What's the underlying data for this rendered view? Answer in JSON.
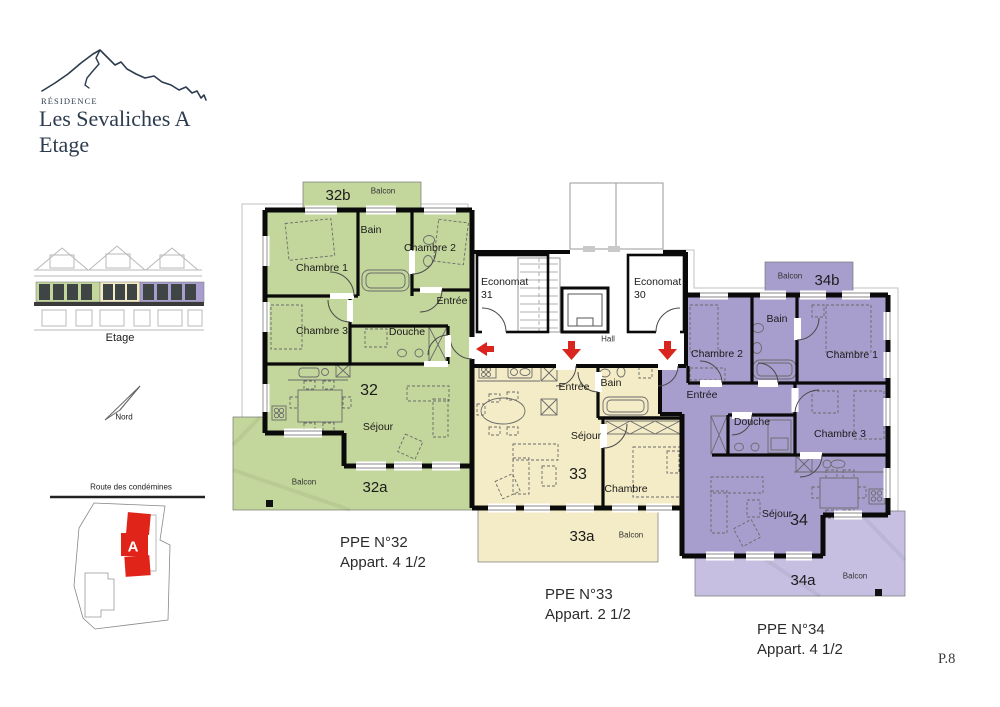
{
  "page": {
    "number": "P.8"
  },
  "logo": {
    "residence": "RÉSIDENCE",
    "name": "Les Sevaliches A",
    "floor": "Etage"
  },
  "elevation": {
    "caption": "Etage"
  },
  "north_arrow": {
    "label": "Nord"
  },
  "site_plan": {
    "road": "Route des condémines",
    "building_letter": "A"
  },
  "colors": {
    "apt32_green": "#c3d69b",
    "apt33_yellow": "#f4ecc6",
    "apt34_purple": "#a89ecd",
    "balcony34_light_purple": "#c6bfe2",
    "site_building_red": "#e02419",
    "arrow_red": "#d9251d",
    "logo_navy": "#2c3b4e"
  },
  "plan": {
    "apt32": {
      "number": "32",
      "sejour": "Séjour",
      "chambre1": "Chambre 1",
      "chambre2": "Chambre 2",
      "chambre3": "Chambre 3",
      "bain": "Bain",
      "douche": "Douche",
      "entree": "Entrée",
      "balcony_top": {
        "id": "32b",
        "label": "Balcon"
      },
      "balcony_main": {
        "id": "32a",
        "label": "Balcon"
      }
    },
    "core": {
      "economat31": {
        "line1": "Economat",
        "line2": "31"
      },
      "economat30": {
        "line1": "Economat",
        "line2": "30"
      },
      "hall": "Hall"
    },
    "apt33": {
      "number": "33",
      "sejour": "Séjour",
      "chambre": "Chambre",
      "bain": "Bain",
      "entree": "Entrée",
      "balcony": {
        "id": "33a",
        "label": "Balcon"
      }
    },
    "apt34": {
      "number": "34",
      "sejour": "Séjour",
      "chambre1": "Chambre 1",
      "chambre2": "Chambre 2",
      "chambre3": "Chambre 3",
      "bain": "Bain",
      "douche": "Douche",
      "entree": "Entrée",
      "balcony_top": {
        "id": "34b",
        "label": "Balcon"
      },
      "balcony_main": {
        "id": "34a",
        "label": "Balcon"
      }
    }
  },
  "footer": {
    "ppe32": {
      "title": "PPE N°32",
      "subtitle": "Appart. 4 1/2"
    },
    "ppe33": {
      "title": "PPE N°33",
      "subtitle": "Appart. 2 1/2"
    },
    "ppe34": {
      "title": "PPE N°34",
      "subtitle": "Appart. 4 1/2"
    }
  }
}
